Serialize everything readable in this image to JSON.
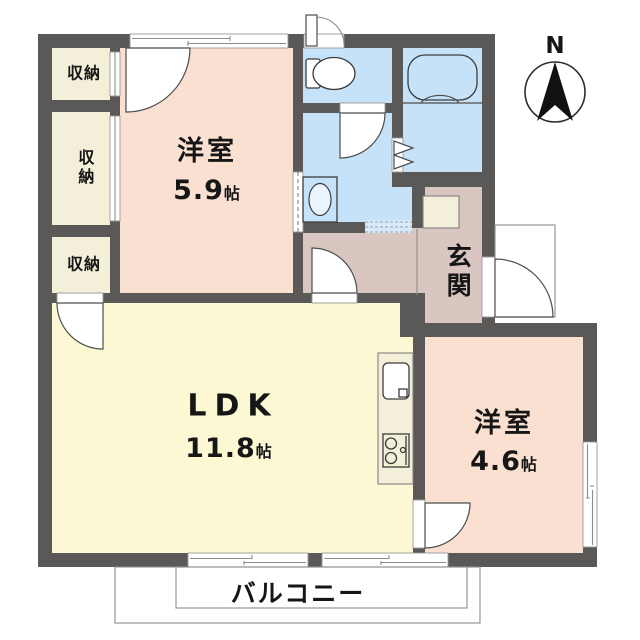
{
  "title": "apartment-floor-plan",
  "compass": {
    "north_label": "N"
  },
  "rooms": {
    "western1": {
      "label": "洋室",
      "size_value": "5.9",
      "size_unit": "帖"
    },
    "ldk": {
      "label": "LDK",
      "size_value": "11.8",
      "size_unit": "帖"
    },
    "western2": {
      "label": "洋室",
      "size_value": "4.6",
      "size_unit": "帖"
    },
    "entrance": {
      "label": "玄関"
    },
    "balcony": {
      "label": "バルコニー"
    }
  },
  "closets": {
    "top": {
      "label": "収納"
    },
    "middle": {
      "label": "収納"
    },
    "bottom": {
      "label": "収納"
    }
  },
  "fixtures": [
    "toilet",
    "bathtub",
    "washing-machine-pan",
    "kitchen-sink",
    "gas-stove",
    "shoe-cabinet"
  ],
  "colors": {
    "wall": "#5b5957",
    "western": "#f9e0d1",
    "ldk": "#fbf8d3",
    "closet": "#f4efd8",
    "wet": "#c6e2f8",
    "wet_step": "#d9e9f8",
    "entrance": "#d9c6c0"
  }
}
